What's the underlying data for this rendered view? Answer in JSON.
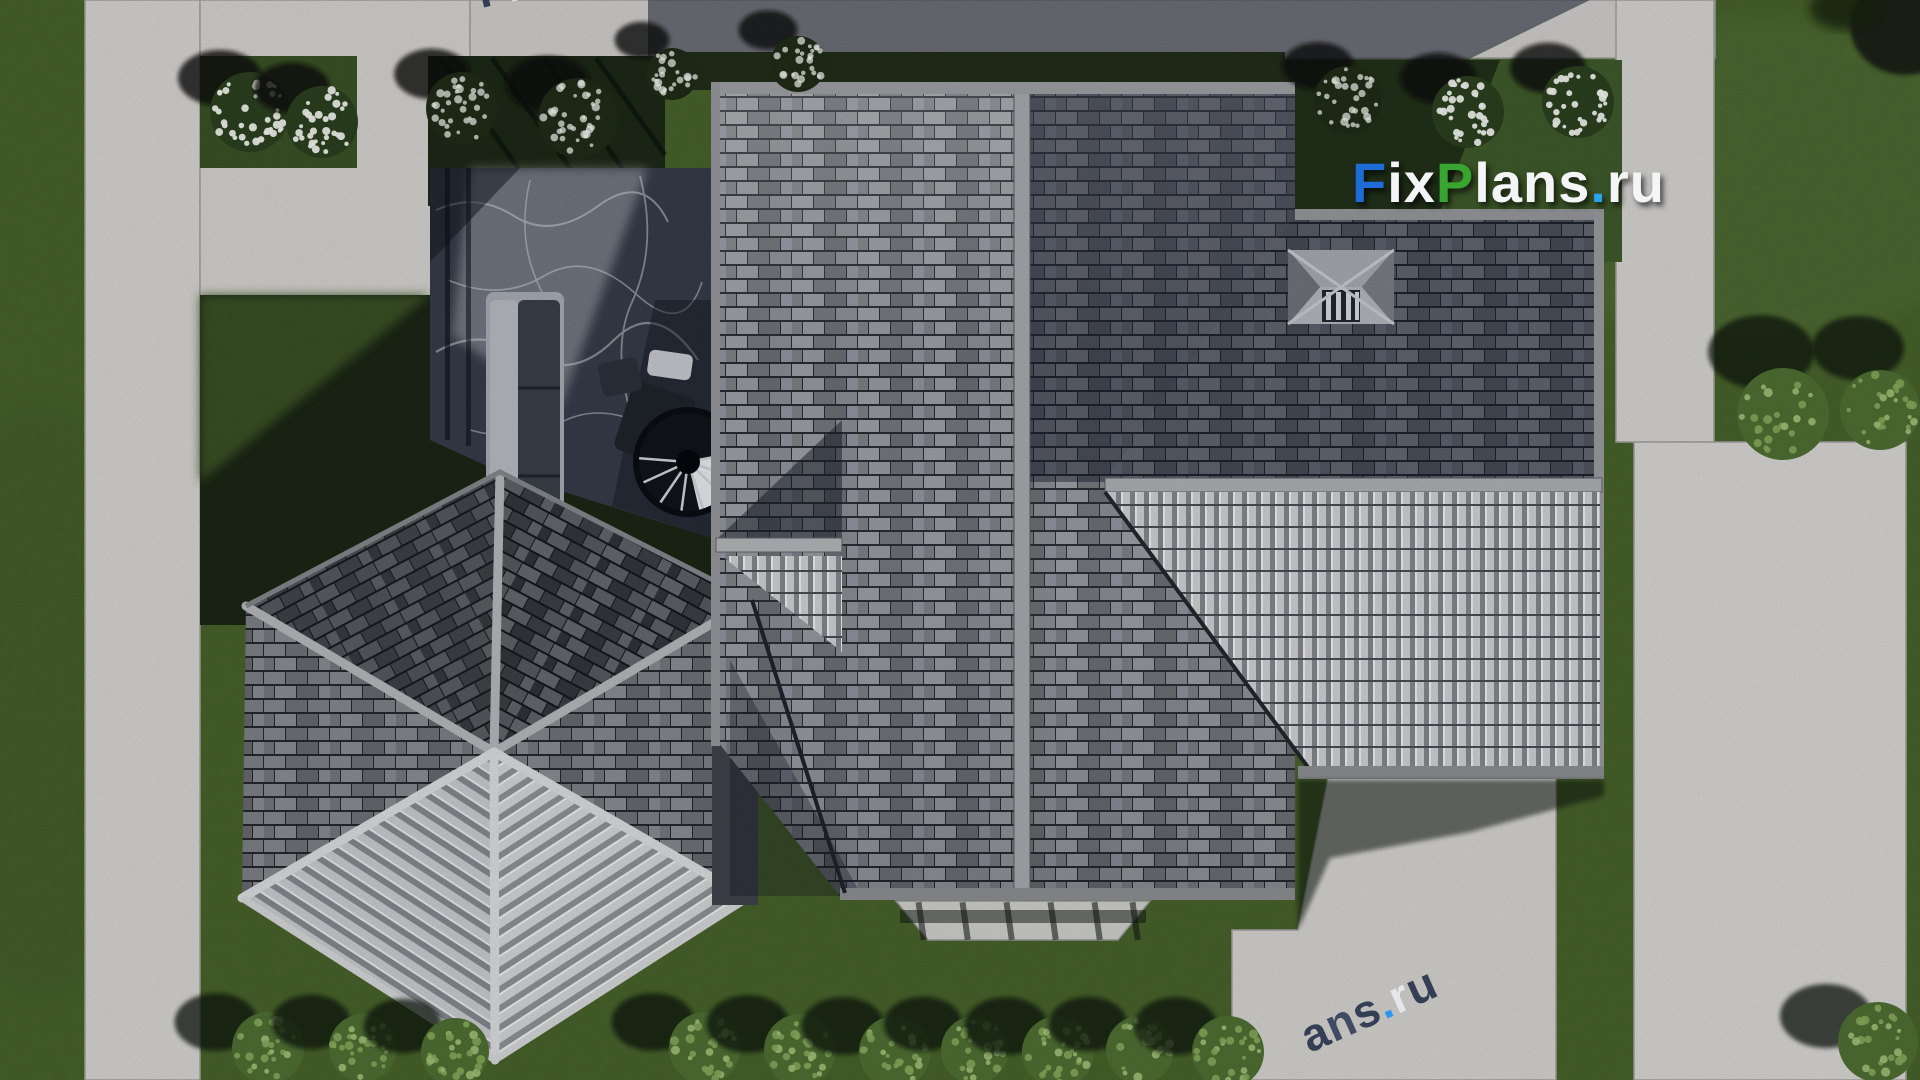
{
  "meta": {
    "title": "Aerial top-down 3D render of a house roof plan with landscaped yard",
    "width": 1920,
    "height": 1080
  },
  "watermark": {
    "text": "FixPlans.ru",
    "parts": [
      {
        "text": "F",
        "color": "#1e6cd6"
      },
      {
        "text": "ix",
        "color": "#f4f5f7"
      },
      {
        "text": "P",
        "color": "#37a52f"
      },
      {
        "text": "lans",
        "color": "#f4f5f7"
      },
      {
        "text": ".",
        "color": "#2aa3ef"
      },
      {
        "text": "ru",
        "color": "#f4f5f7"
      }
    ],
    "fragment_top_left": {
      "text": "FixPlans.ru",
      "parts": [
        {
          "text": "F",
          "color": "#2d3950"
        },
        {
          "text": "ix",
          "color": "#e9eaee"
        },
        {
          "text": "P",
          "color": "#2196f3"
        },
        {
          "text": "la",
          "color": "#2d3950"
        },
        {
          "text": "n",
          "color": "#e9eaee"
        },
        {
          "text": "s",
          "color": "#d7d9de"
        },
        {
          "text": ".",
          "color": "#2d3950"
        },
        {
          "text": "r",
          "color": "#3fa63c"
        },
        {
          "text": "u",
          "color": "#3fa63c"
        }
      ]
    },
    "fragment_bottom_right": {
      "text": "ans.ru",
      "parts": [
        {
          "text": "a",
          "color": "#2d3950"
        },
        {
          "text": "n",
          "color": "#39455e"
        },
        {
          "text": "s",
          "color": "#2d3950"
        },
        {
          "text": ".",
          "color": "#2196f3"
        },
        {
          "text": "r",
          "color": "#e9eaee"
        },
        {
          "text": "u",
          "color": "#2d3950"
        }
      ]
    }
  },
  "palette": {
    "lawn": "#4c6530",
    "lawn_dark_bed": "#1b2615",
    "concrete": "#d6d5d2",
    "concrete_shadow": "#2e3442",
    "marble_terrace": "#353c49",
    "roof_tile_light": "#9da0a5",
    "roof_tile_mid": "#74777d",
    "roof_tile_dark": "#45484e",
    "ridge": "#aeb0b4",
    "rib_highlight": "#d0d1d4",
    "bush_green": "#86aa5c",
    "flower_white": "#f2f4ef"
  },
  "objects": {
    "flower_shrubs": [
      {
        "cx": 250,
        "cy": 112,
        "r": 40,
        "dark": false
      },
      {
        "cx": 322,
        "cy": 122,
        "r": 36,
        "dark": false
      },
      {
        "cx": 462,
        "cy": 108,
        "r": 36,
        "dark": true
      },
      {
        "cx": 578,
        "cy": 118,
        "r": 40,
        "dark": true
      },
      {
        "cx": 672,
        "cy": 74,
        "r": 26,
        "dark": true
      },
      {
        "cx": 798,
        "cy": 64,
        "r": 28,
        "dark": true
      },
      {
        "cx": 1348,
        "cy": 100,
        "r": 34,
        "dark": true
      },
      {
        "cx": 1468,
        "cy": 112,
        "r": 36,
        "dark": false
      },
      {
        "cx": 1578,
        "cy": 102,
        "r": 36,
        "dark": false
      }
    ],
    "bottom_bushes": [
      {
        "cx": 268,
        "cy": 1048,
        "r": 36
      },
      {
        "cx": 363,
        "cy": 1048,
        "r": 34
      },
      {
        "cx": 455,
        "cy": 1052,
        "r": 34
      },
      {
        "cx": 705,
        "cy": 1048,
        "r": 36
      },
      {
        "cx": 800,
        "cy": 1050,
        "r": 36
      },
      {
        "cx": 895,
        "cy": 1052,
        "r": 36
      },
      {
        "cx": 975,
        "cy": 1050,
        "r": 34
      },
      {
        "cx": 1058,
        "cy": 1052,
        "r": 36
      },
      {
        "cx": 1140,
        "cy": 1050,
        "r": 34
      },
      {
        "cx": 1228,
        "cy": 1052,
        "r": 36
      },
      {
        "cx": 1878,
        "cy": 1042,
        "r": 40
      }
    ],
    "right_bushes": [
      {
        "cx": 1783,
        "cy": 414,
        "r": 46
      },
      {
        "cx": 1880,
        "cy": 410,
        "r": 40
      }
    ]
  }
}
